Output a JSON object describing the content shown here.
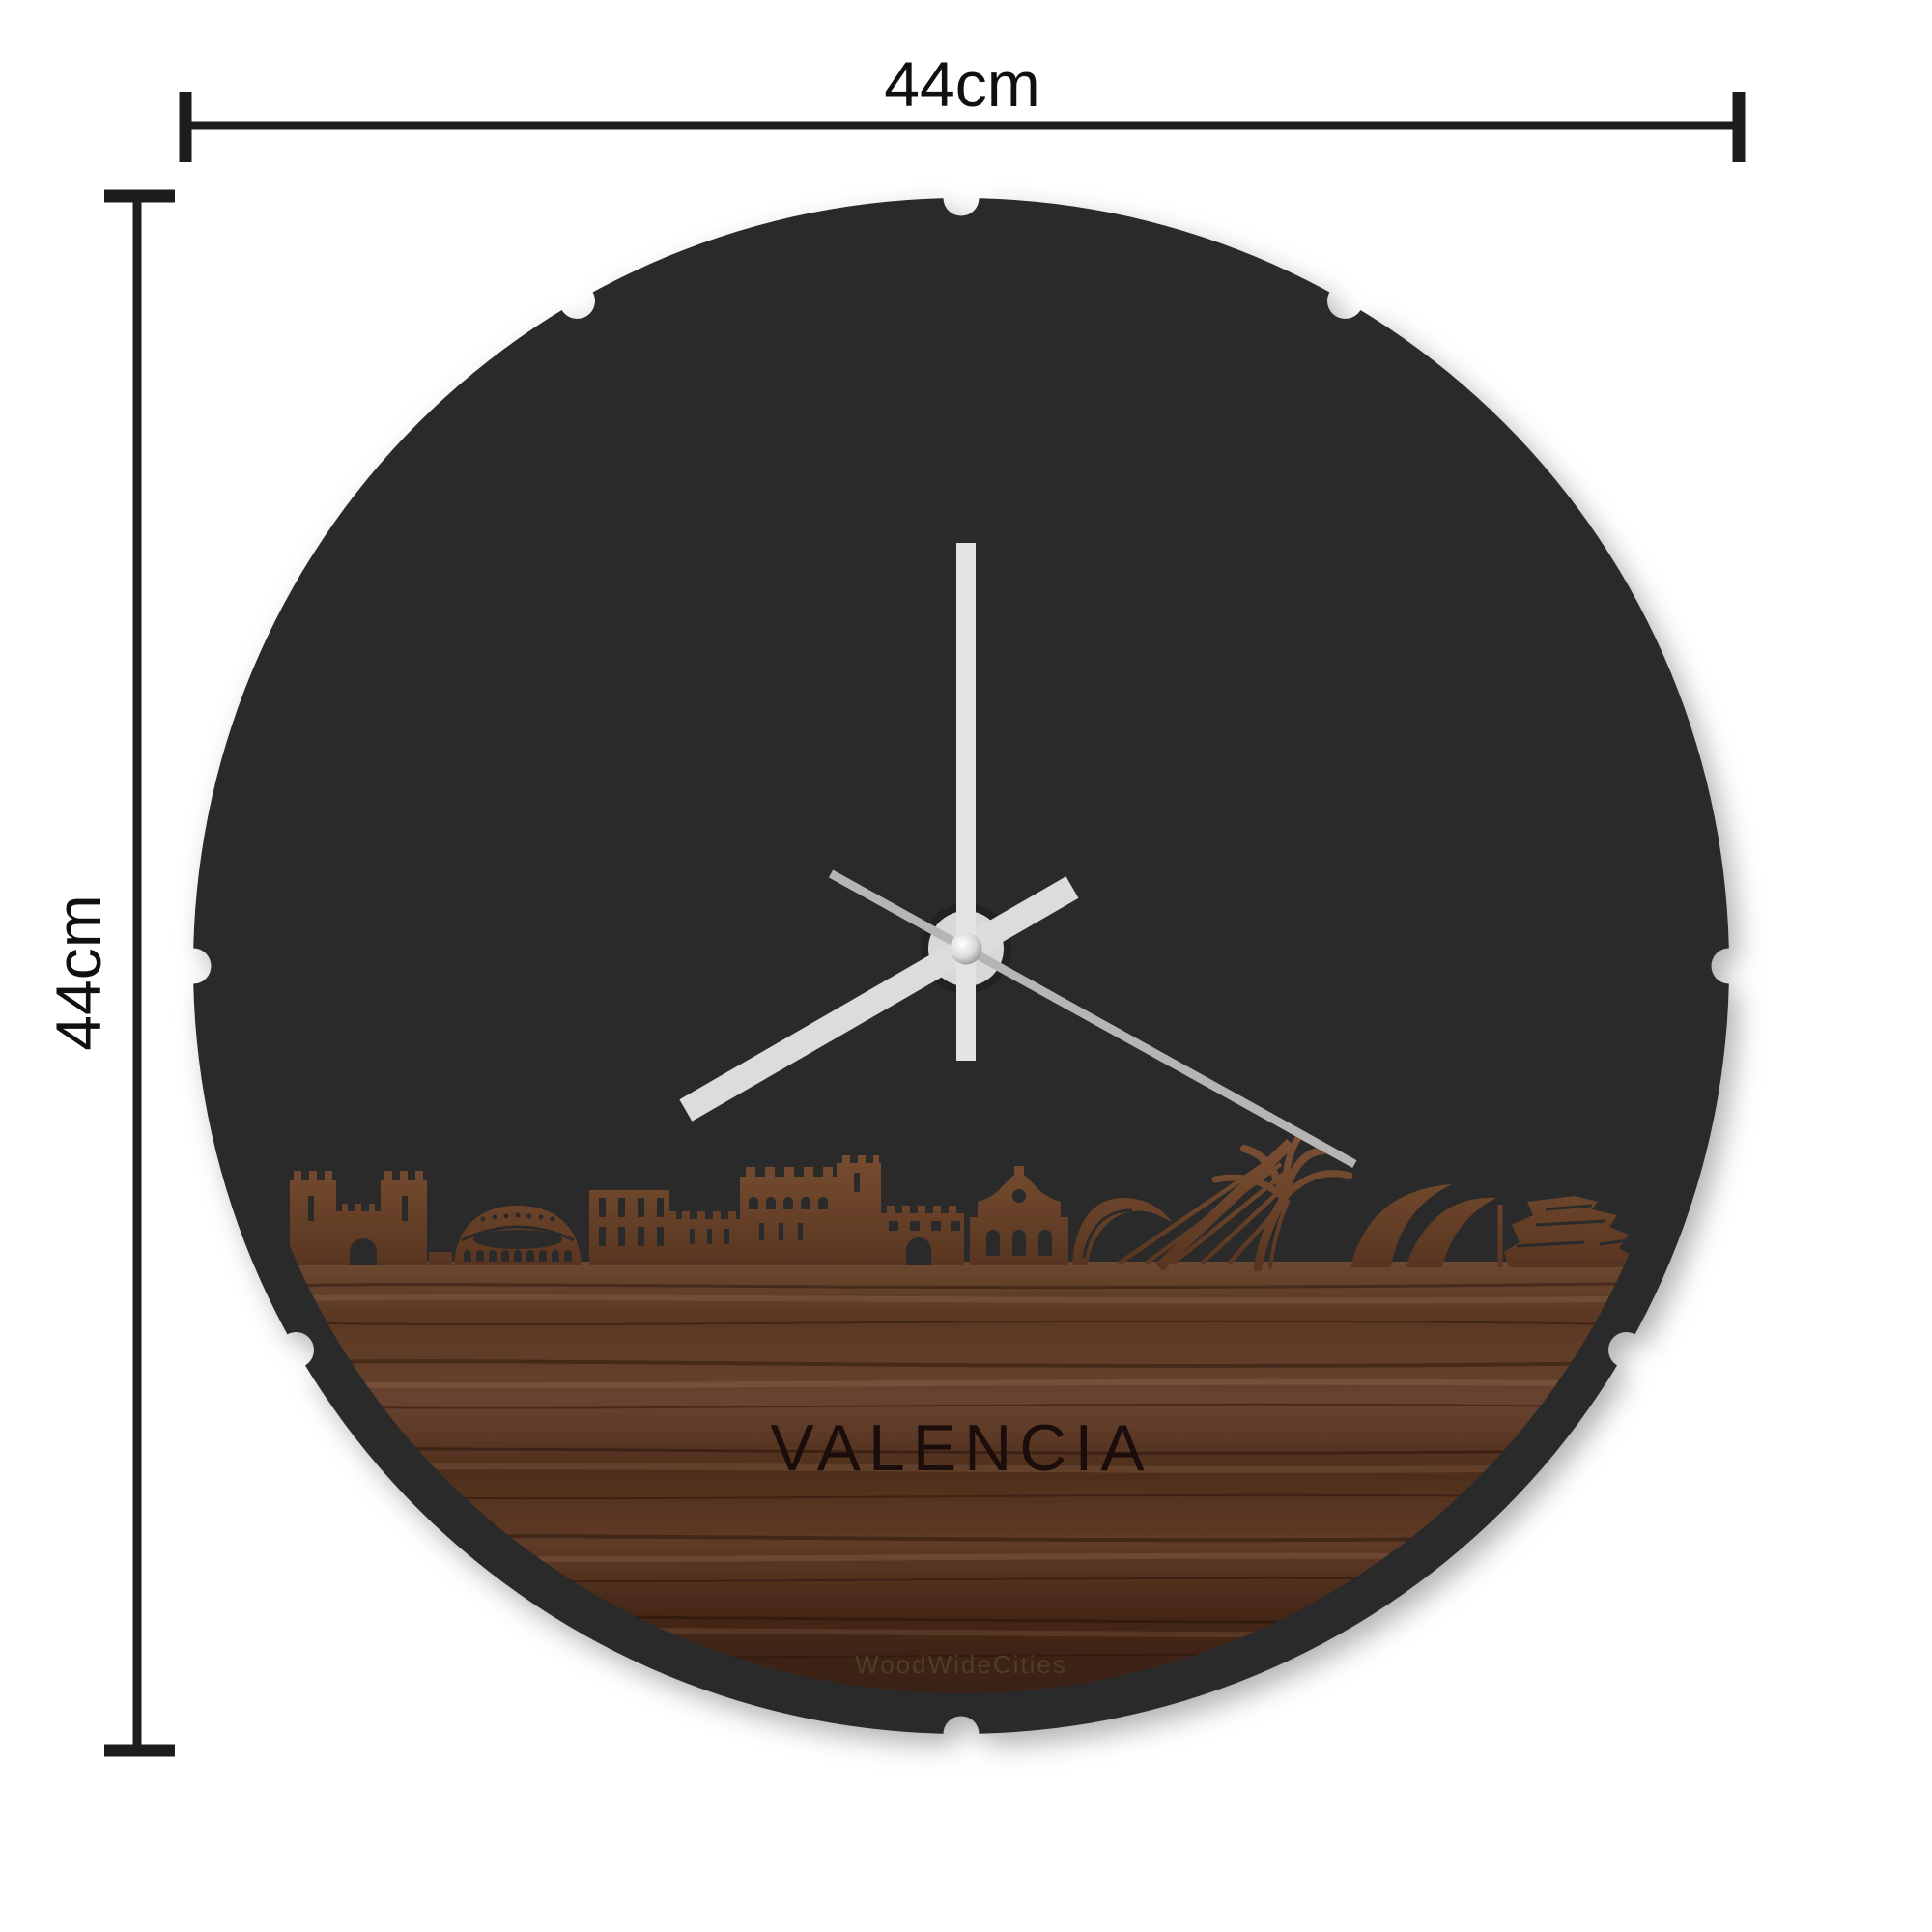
{
  "dimensions": {
    "width_label": "44cm",
    "height_label": "44cm"
  },
  "clock": {
    "city_label": "VALENCIA",
    "watermark": "WoodWideCities",
    "hands": {
      "minute_deg": 0,
      "hour_deg": 240,
      "second_deg": 119
    },
    "colors": {
      "face": "#2b2a29",
      "hand_light": "#e4e4e4",
      "hand_second": "#b5b5b5",
      "dimension": "#1d1d1d",
      "engraving": "#1c1008",
      "wood_mid": "#5f3c26",
      "wood_dark": "#3a2113",
      "wood_light": "#7b5134",
      "background": "#ffffff"
    }
  }
}
